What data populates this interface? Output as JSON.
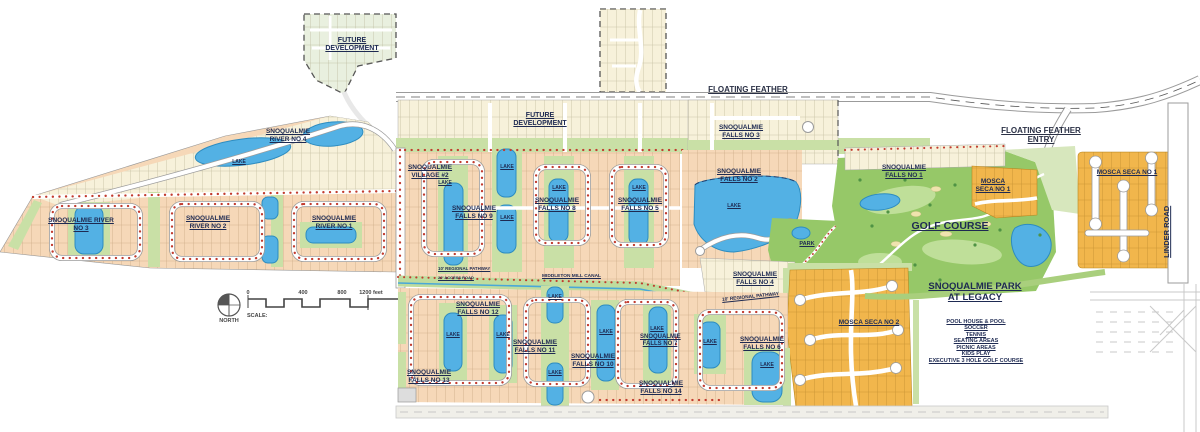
{
  "labels": {
    "future_dev_nw": "FUTURE DEVELOPMENT",
    "future_dev_mid": "FUTURE DEVELOPMENT",
    "floating_feather": "FLOATING FEATHER",
    "floating_feather_entry": "FLOATING FEATHER ENTRY",
    "river_no_4": "SNOQUALMIE RIVER NO 4",
    "river_no_3": "SNOQUALMIE RIVER NO 3",
    "river_no_2": "SNOQUALMIE RIVER NO 2",
    "river_no_1": "SNOQUALMIE RIVER NO 1",
    "village_2": "SNOQUALMIE VILLAGE #2",
    "falls_no_9": "SNOQUALMIE FALLS NO 9",
    "falls_no_8": "SNOQUALMIE FALLS NO 8",
    "falls_no_5": "SNOQUALMIE FALLS NO 5",
    "falls_no_3": "SNOQUALMIE FALLS NO 3",
    "falls_no_2": "SNOQUALMIE FALLS NO 2",
    "falls_no_1": "SNOQUALMIE FALLS NO 1",
    "falls_no_4": "SNOQUALMIE FALLS NO 4",
    "falls_no_6": "SNOQUALMIE FALLS NO 6",
    "falls_no_7": "SNOQUALMIE FALLS NO 7",
    "falls_no_10": "SNOQUALMIE FALLS NO 10",
    "falls_no_11": "SNOQUALMIE FALLS NO 11",
    "falls_no_12": "SNOQUALMIE FALLS NO 12",
    "falls_no_13": "SNOQUALMIE FALLS NO 13",
    "falls_no_14": "SNOQUALMIE FALLS NO 14",
    "mosca_seca_no_1": "MOSCA SECA NO 1",
    "mosca_seca_no_2": "MOSCA SECA NO 2",
    "golf_course": "GOLF COURSE",
    "park": "PARK",
    "lake": "LAKE",
    "linder_road": "LINDER ROAD",
    "regional_pathway": "10' REGIONAL PATHWAY",
    "access_road": "20' ACCESS ROAD",
    "middleton_mill_canal": "MIDDLETON MILL CANAL"
  },
  "legacy_park": {
    "title": "SNOQUALMIE PARK AT LEGACY",
    "amenities": [
      "POOL HOUSE & POOL",
      "SOCCER",
      "TENNIS",
      "SEATING AREAS",
      "PICNIC AREAS",
      "KIDS PLAY",
      "EXECUTIVE 3 HOLE GOLF COURSE"
    ]
  },
  "map_key": {
    "north_label": "NORTH",
    "scale_label": "SCALE:",
    "scale_ticks": [
      "0",
      "400",
      "800",
      "1200 feet"
    ]
  },
  "colors": {
    "lot_peach": "#f6d8b8",
    "lot_cream": "#f7f1da",
    "mosca_orange": "#f1b64c",
    "green_strip": "#c9e0a6",
    "golf_green": "#96c868",
    "lake_blue": "#53b1e4",
    "tree_red": "#c23b2e",
    "label_navy": "#1e2a52"
  }
}
